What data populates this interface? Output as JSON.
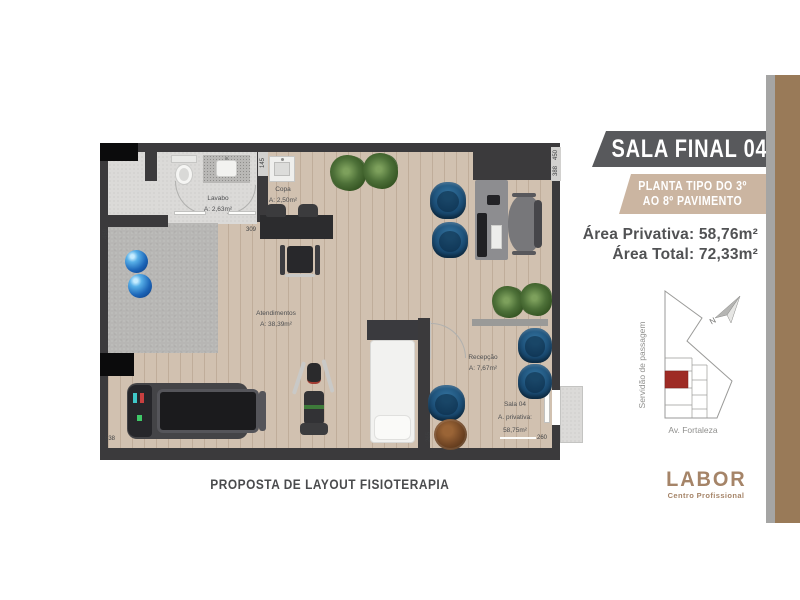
{
  "header": {
    "title": "SALA FINAL 04",
    "subtitle_line1": "PLANTA TIPO DO 3º",
    "subtitle_line2": "AO 8º PAVIMENTO",
    "area_privativa": "Área Privativa: 58,76m²",
    "area_total": "Área Total: 72,33m²"
  },
  "site_map": {
    "street_left": "Servidão de passagem",
    "street_bottom": "Av. Fortaleza",
    "north": "N"
  },
  "logo": {
    "brand": "LABOR",
    "tagline": "Centro Profissional"
  },
  "caption": "PROPOSTA DE LAYOUT FISIOTERAPIA",
  "plan": {
    "rooms": {
      "lavabo": {
        "name": "Lavabo",
        "area": "A: 2,63m²"
      },
      "copa": {
        "name": "Copa",
        "area": "A: 2,50m²"
      },
      "atendimentos": {
        "name": "Atendimentos",
        "area": "A: 38,39m²"
      },
      "recepcao": {
        "name": "Recepção",
        "area": "A: 7,67m²"
      },
      "sala04": {
        "name": "Sala 04",
        "line2": "A. privativa:",
        "line3": "58,75m²"
      }
    },
    "dimensions": {
      "left_top": "459",
      "left_bottom": "638",
      "copa_wall": "145",
      "copa_bottom": "309",
      "right_top_a": "450",
      "right_top_b": "388",
      "bottom_right": "260",
      "reception_left": "265"
    }
  },
  "colors": {
    "banner_dark": "#58595c",
    "banner_tan": "#cbb5a1",
    "stripe_brown": "#997a58",
    "stripe_gray": "#a5a5a4",
    "logo_brown": "#a58468",
    "wall": "#3b3a3c",
    "accent_unit": "#9e2b25",
    "chair_blue": "#1b4d75"
  }
}
